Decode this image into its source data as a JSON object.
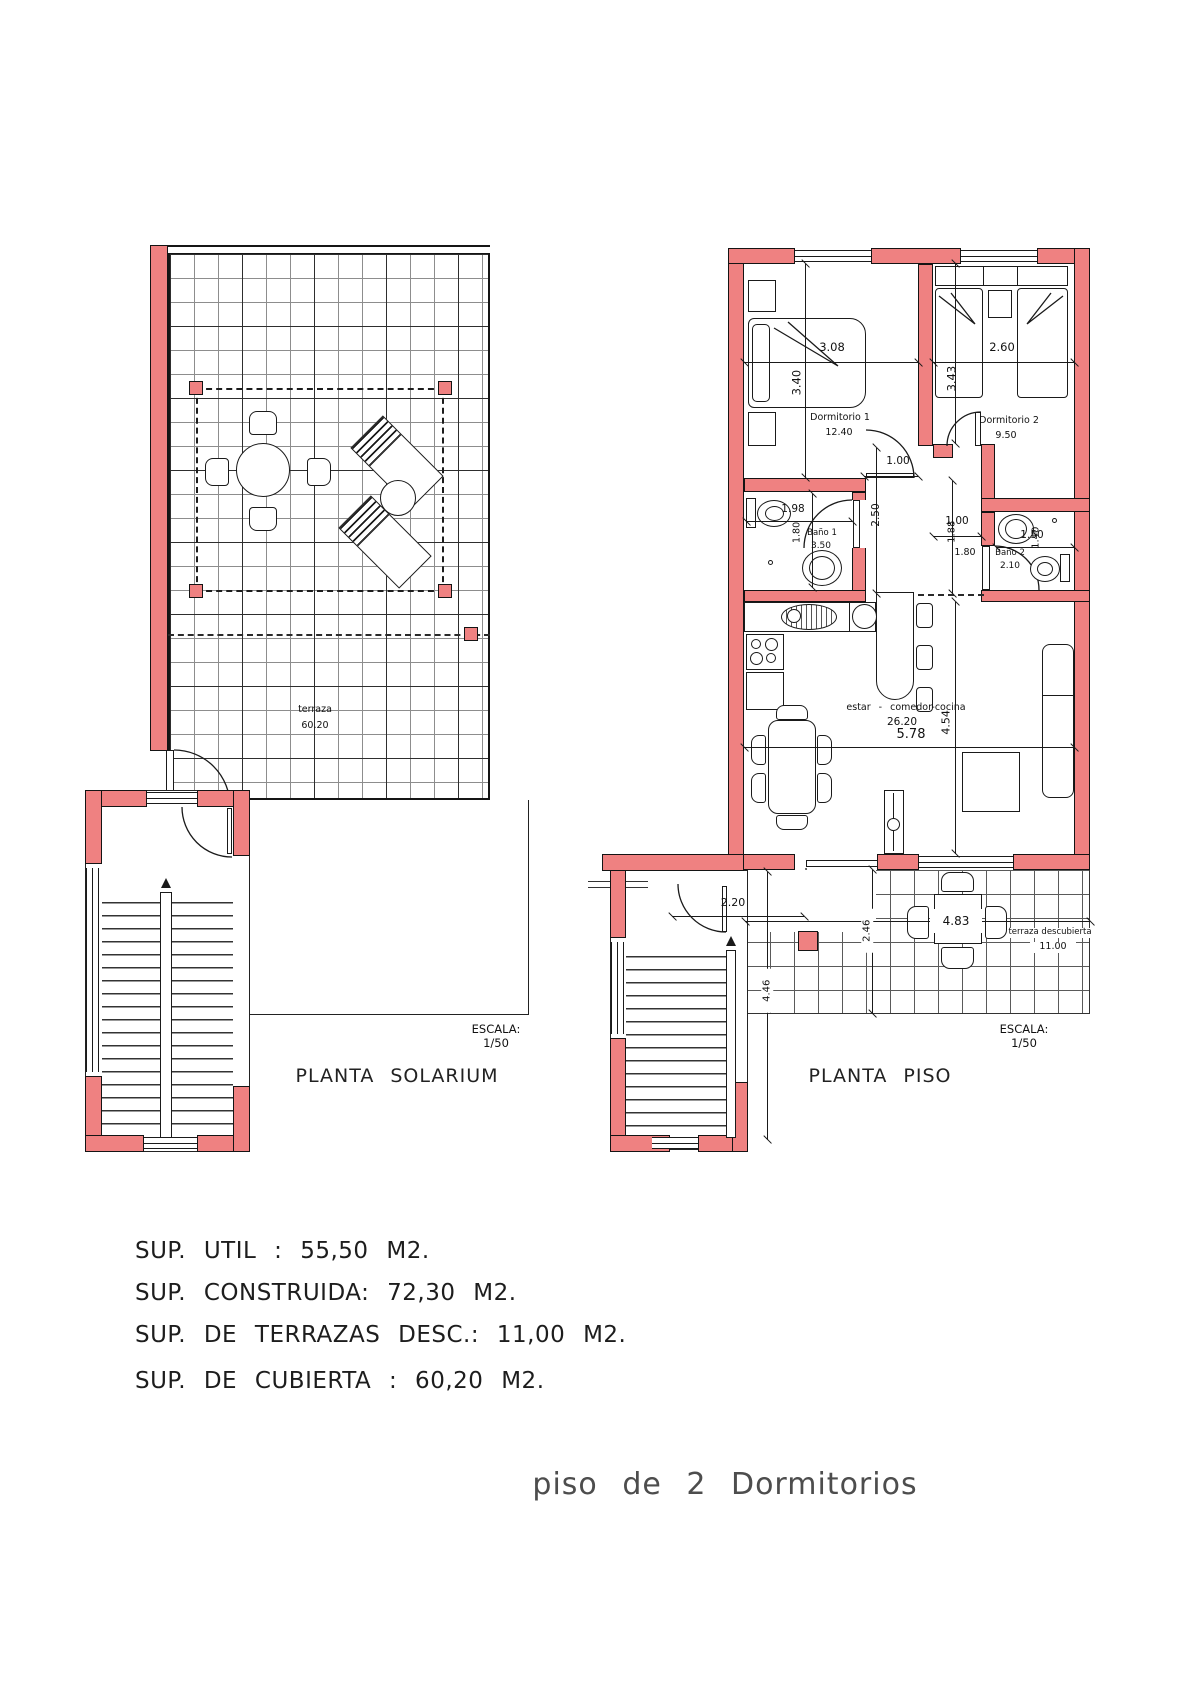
{
  "colors": {
    "wall_fill": "#ef8181",
    "line": "#1a1a1a"
  },
  "left_plan": {
    "title": "PLANTA SOLARIUM",
    "escala": {
      "label": "ESCALA:",
      "value": "1/50"
    },
    "terraza": {
      "label": "terraza",
      "area": "60.20"
    }
  },
  "right_plan": {
    "title": "PLANTA PISO",
    "escala": {
      "label": "ESCALA:",
      "value": "1/50"
    },
    "dorm1": {
      "name": "Dormitorio 1",
      "area": "12.40",
      "width": "3.08",
      "depth": "3.40"
    },
    "dorm2": {
      "name": "Dormitorio 2",
      "area": "9.50",
      "width": "2.60",
      "depth": "3.43"
    },
    "bano1": {
      "name": "Baño 1",
      "area": "3.50",
      "width": "1.98",
      "depth": "1.80"
    },
    "bano2": {
      "name": "Baño 2",
      "area": "2.10",
      "width": "1.50",
      "depth": "1.40",
      "side": "1.80"
    },
    "hall": {
      "width": "1.00",
      "length": "2.50"
    },
    "hall2": {
      "width": "1.00",
      "length": "1.88"
    },
    "living": {
      "name": "estar - comedor-cocina",
      "area": "26.20",
      "width": "5.78",
      "depth": "4.54"
    },
    "terrace": {
      "name": "terraza descubierta",
      "area": "11.00",
      "width": "4.83",
      "depth": "2.46"
    },
    "stairs": {
      "width": "2.20",
      "length": "4.46"
    }
  },
  "summary": {
    "lines": [
      "SUP. UTIL : 55,50 M2.",
      "SUP. CONSTRUIDA: 72,30 M2.",
      "SUP. DE TERRAZAS DESC.: 11,00 M2.",
      "SUP. DE CUBIERTA : 60,20 M2."
    ]
  },
  "footer": {
    "title": "piso de 2 Dormitorios"
  }
}
